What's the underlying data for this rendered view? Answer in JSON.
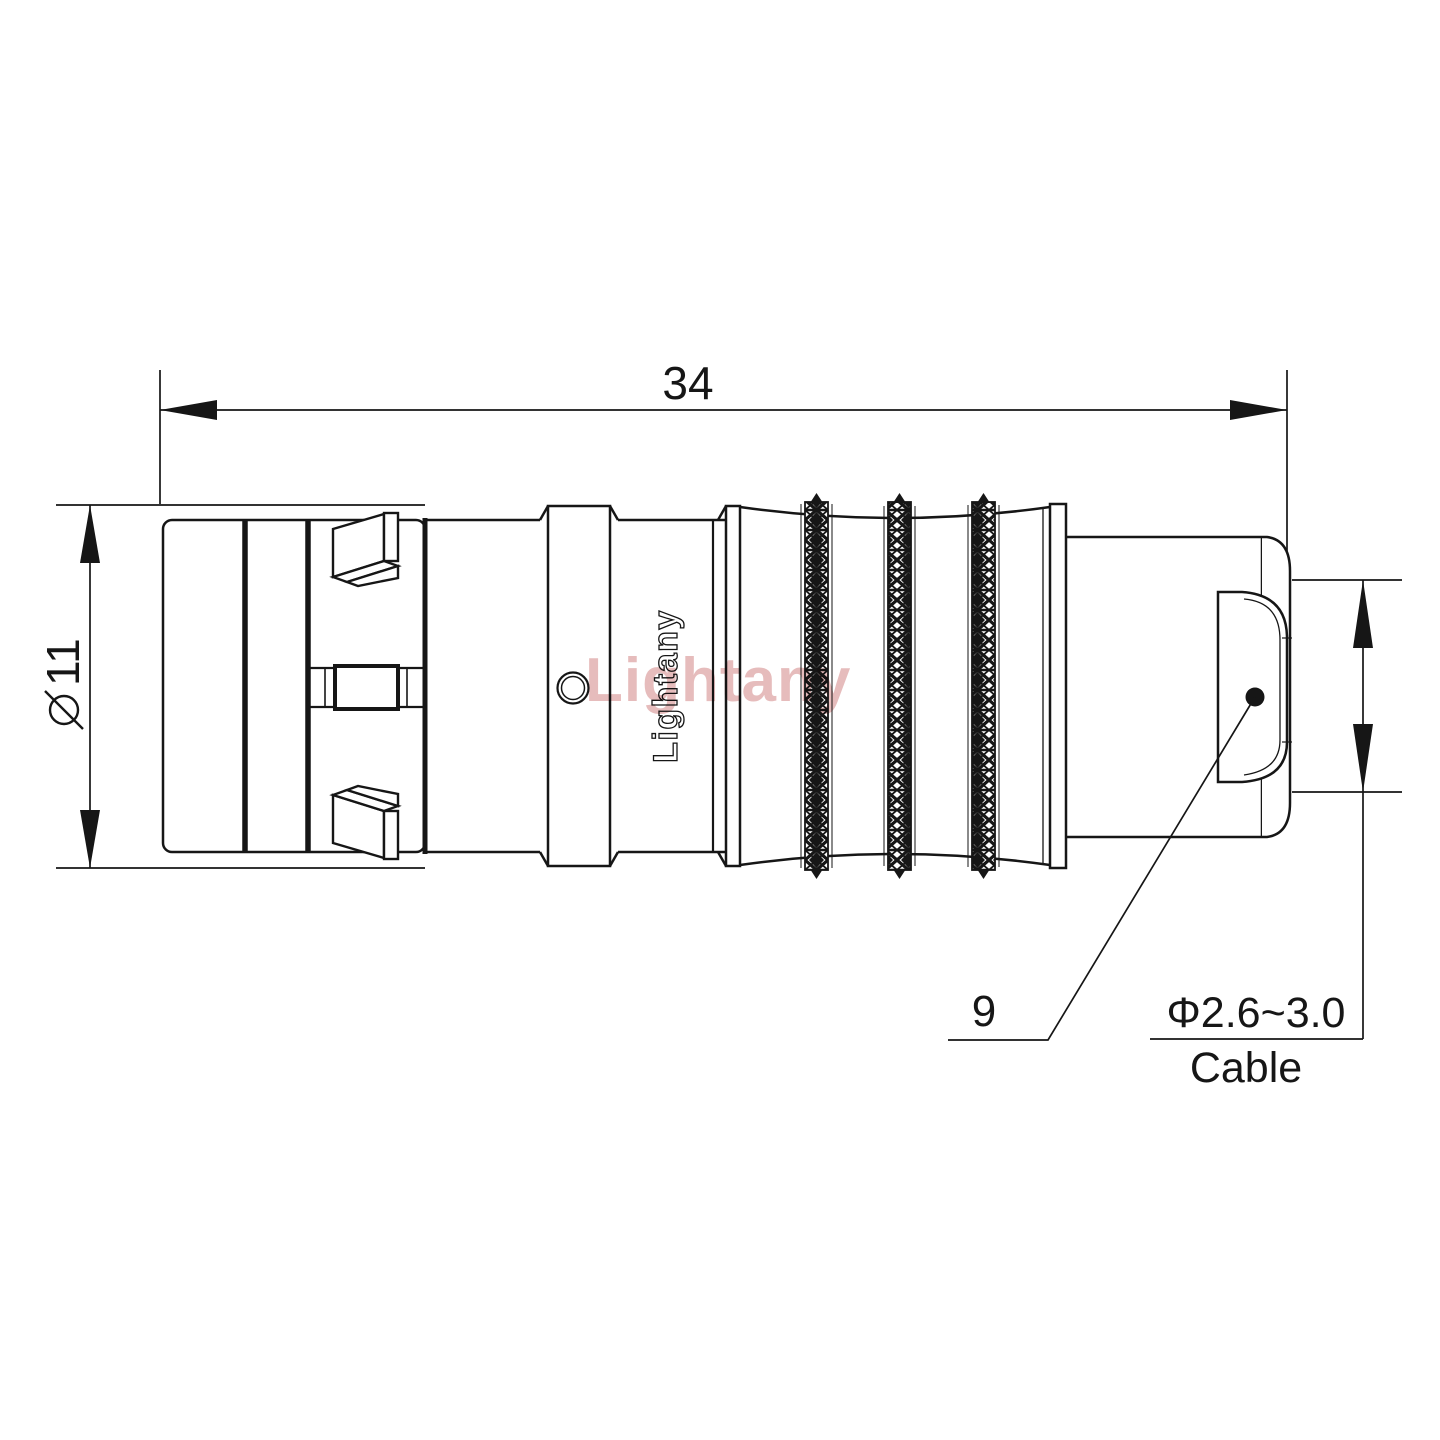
{
  "labels": {
    "length_dim": "34",
    "diameter_symbol": "⌀",
    "diameter_value": "11",
    "boot_dim": "9",
    "cable_spec": "Φ2.6~3.0",
    "cable_word": "Cable",
    "brand_engraving": "Lightany",
    "watermark": "Lightany"
  },
  "colors": {
    "line": "#161616",
    "watermark_pink": "#d68f8f",
    "background": "#ffffff"
  }
}
